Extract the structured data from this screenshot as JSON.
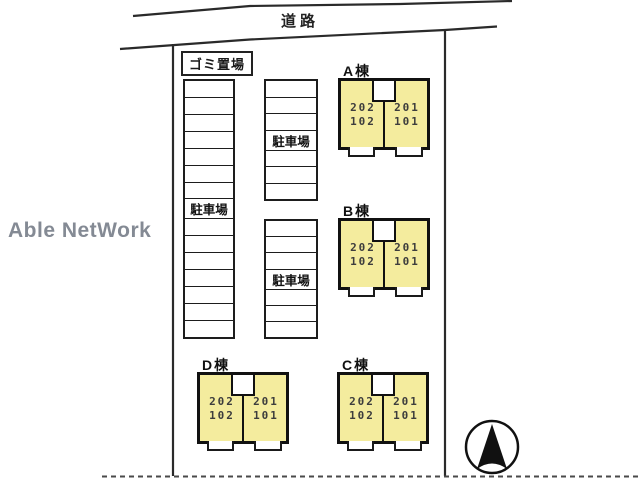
{
  "road": {
    "label": "道路"
  },
  "garbage_area": {
    "label": "ゴミ置場"
  },
  "parking": {
    "label": "駐車場",
    "columns": [
      {
        "position": "left",
        "stalls": 15,
        "label_row": 8
      },
      {
        "position": "middle-top",
        "stalls": 7,
        "label_row": 4
      },
      {
        "position": "middle-bottom",
        "stalls": 7,
        "label_row": 4
      }
    ]
  },
  "buildings": {
    "fill_color": "#f4ec9e",
    "items": [
      {
        "name": "A棟",
        "units": [
          {
            "upper": "202",
            "lower": "102"
          },
          {
            "upper": "201",
            "lower": "101"
          }
        ]
      },
      {
        "name": "B棟",
        "units": [
          {
            "upper": "202",
            "lower": "102"
          },
          {
            "upper": "201",
            "lower": "101"
          }
        ]
      },
      {
        "name": "C棟",
        "units": [
          {
            "upper": "202",
            "lower": "102"
          },
          {
            "upper": "201",
            "lower": "101"
          }
        ]
      },
      {
        "name": "D棟",
        "units": [
          {
            "upper": "202",
            "lower": "102"
          },
          {
            "upper": "201",
            "lower": "101"
          }
        ]
      }
    ]
  },
  "watermark": {
    "text": "Able NetWork",
    "color": "#848a94"
  },
  "compass": {
    "icon": "north-arrow"
  },
  "colors": {
    "line": "#1d1d1d",
    "building_fill": "#f4ec9e"
  }
}
